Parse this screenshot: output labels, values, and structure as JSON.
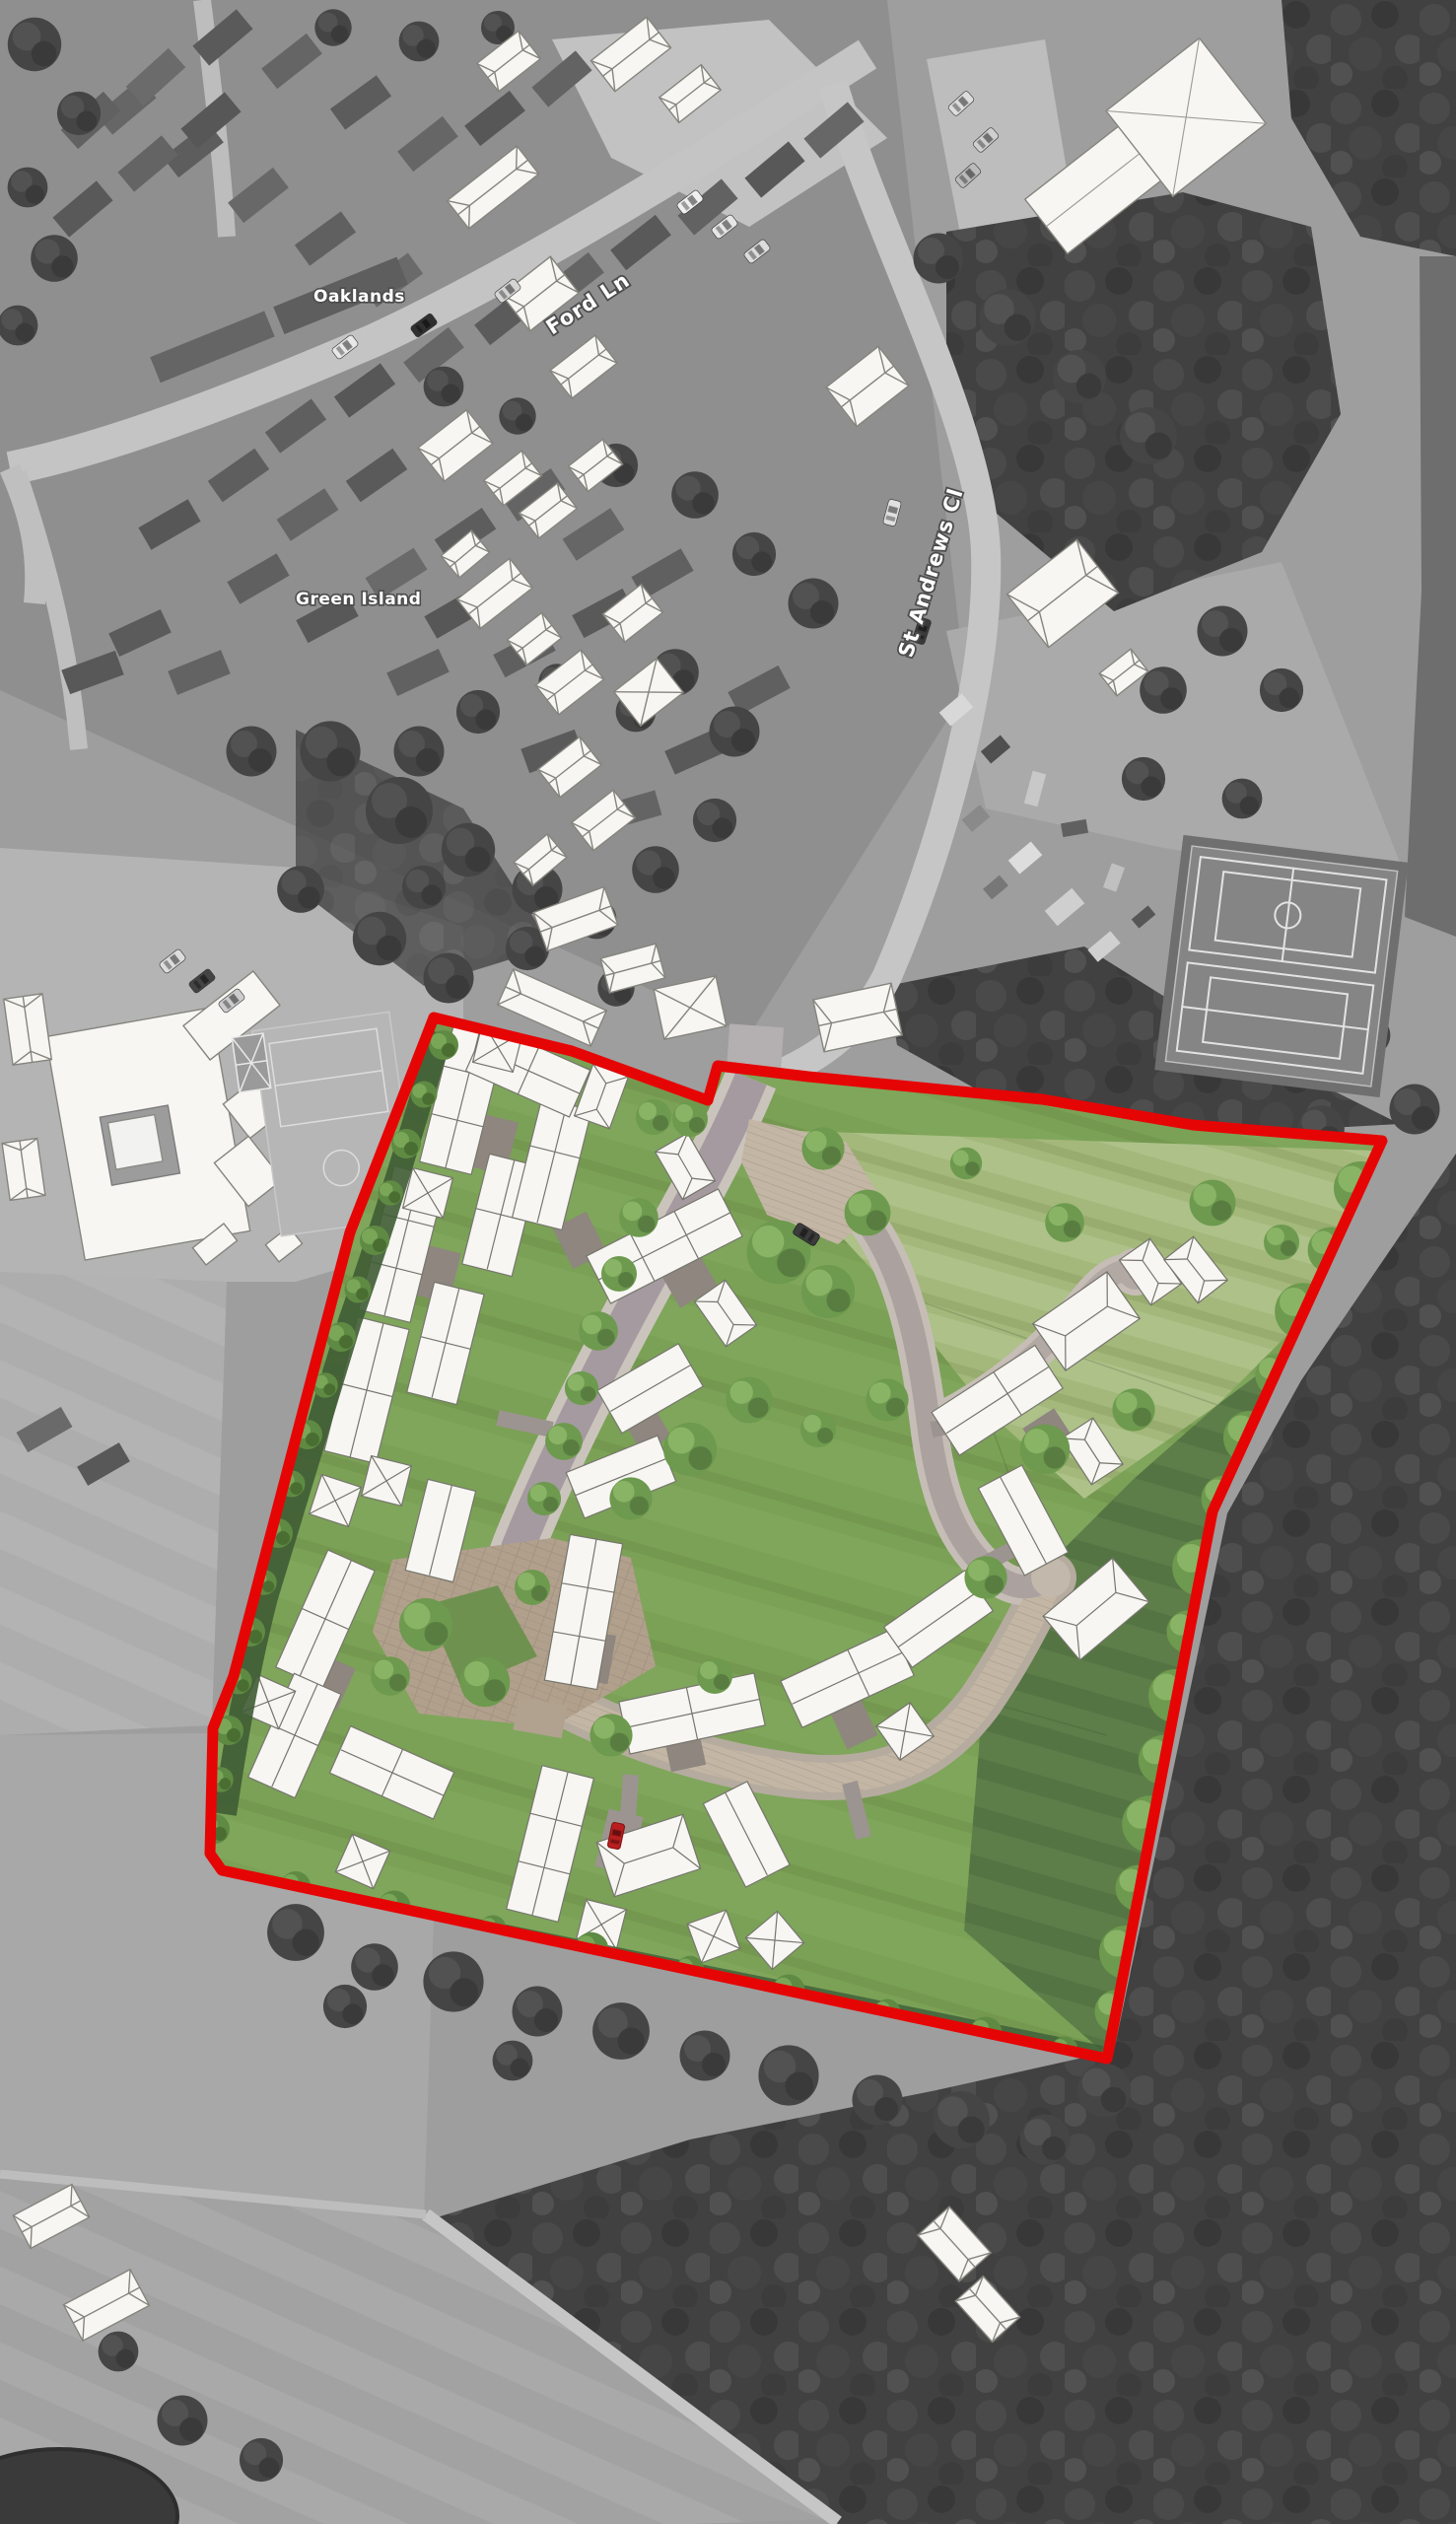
{
  "figure": {
    "road_labels": [
      {
        "text": "Ford Ln"
      },
      {
        "text": "St Andrews Cl"
      }
    ],
    "place_labels": [
      {
        "text": "Oaklands"
      },
      {
        "text": "Green Island"
      }
    ],
    "colors": {
      "site_boundary_red": "#e60505",
      "masterplan_lawn_green": "#7ba156",
      "meadow_green": "#a3b87a",
      "rough_pasture_green": "#5d7e49",
      "hedge_green": "#6d9a4e",
      "street_asphalt": "#a59aa0",
      "shared_surface_paving": "#c3b6a4",
      "proposed_building_white": "#f7f6f3",
      "aerial_photo_gray": "#9e9e9e",
      "woodland_gray": "#414141",
      "red_car": "#b81f1f"
    }
  }
}
